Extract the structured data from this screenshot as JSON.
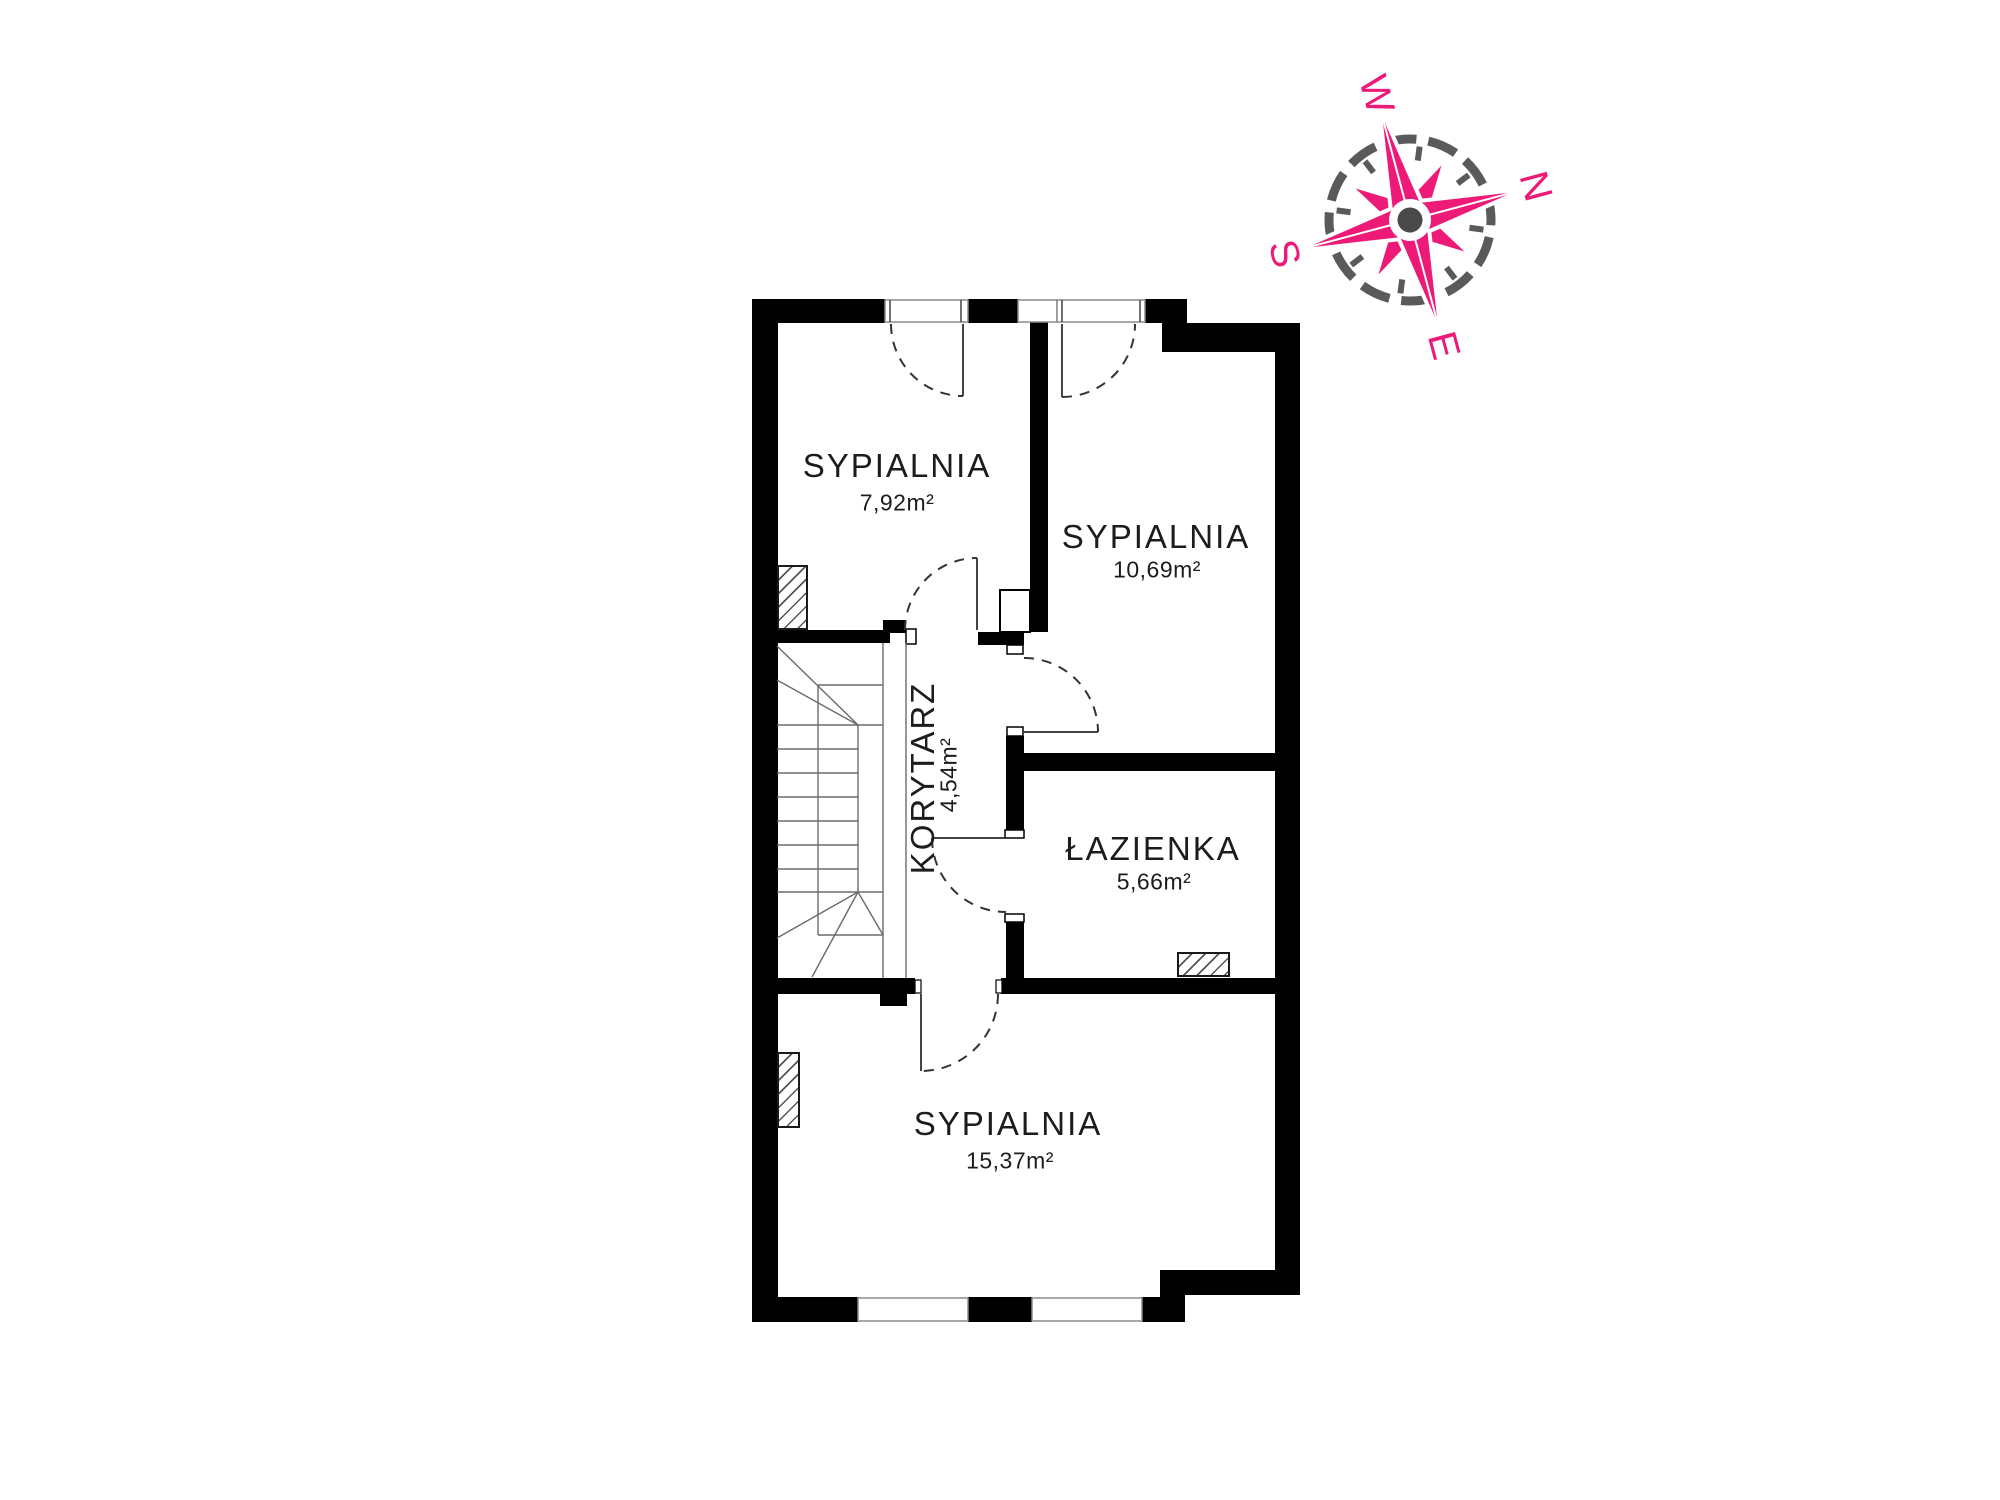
{
  "plan": {
    "rooms": {
      "bedroom1": {
        "name": "SYPIALNIA",
        "area": "7,92m²"
      },
      "bedroom2": {
        "name": "SYPIALNIA",
        "area": "10,69m²"
      },
      "corridor": {
        "name": "KORYTARZ",
        "area": "4,54m²"
      },
      "bathroom": {
        "name": "ŁAZIENKA",
        "area": "5,66m²"
      },
      "bedroom3": {
        "name": "SYPIALNIA",
        "area": "15,37m²"
      }
    },
    "wall_color": "#000000",
    "text_color": "#1c1c1c"
  },
  "compass": {
    "north": "N",
    "south": "S",
    "east": "E",
    "west": "W",
    "accent_color": "#EE1A78",
    "ring_color": "#5A5A5C"
  }
}
